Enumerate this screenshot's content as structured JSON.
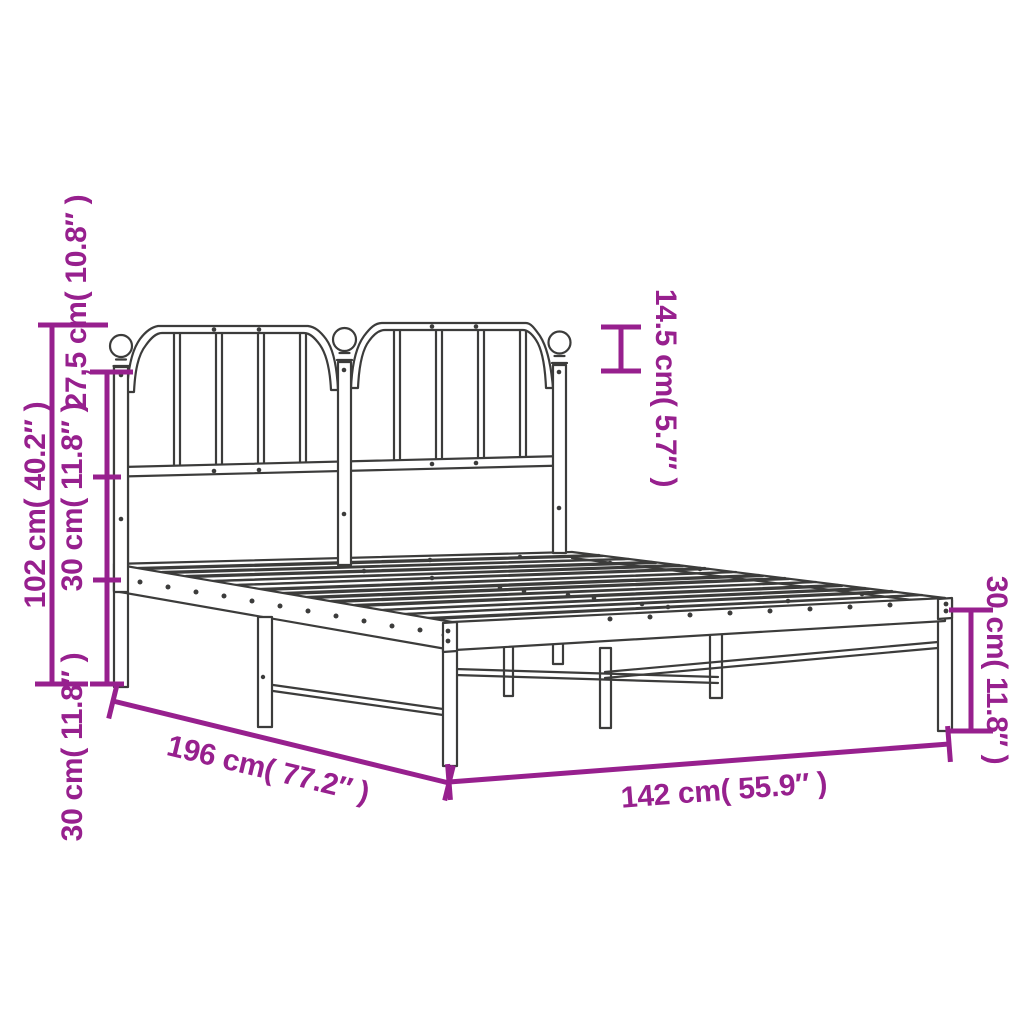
{
  "colors": {
    "dimension": "#97208E",
    "line_art": "#3C3C3B",
    "background": "#FFFFFF"
  },
  "dimensions": {
    "total_height": {
      "cm": "102",
      "inches": "40.2",
      "label": "102 cm( 40.2″ )"
    },
    "headboard_upper_section": {
      "cm": "27,5",
      "inches": "10.8",
      "label": "27,5 cm( 10.8″ )"
    },
    "headboard_middle_section": {
      "cm": "30",
      "inches": "11.8",
      "label": "30 cm( 11.8″ )"
    },
    "headboard_lower_section": {
      "cm": "30",
      "inches": "11.8",
      "label": "30 cm( 11.8″ )"
    },
    "finial_height": {
      "cm": "14.5",
      "inches": "5.7",
      "label": "14.5 cm( 5.7″ )"
    },
    "leg_height": {
      "cm": "30",
      "inches": "11.8",
      "label": "30 cm( 11.8″ )"
    },
    "frame_length": {
      "cm": "196",
      "inches": "77.2",
      "label": "196 cm( 77.2″ )"
    },
    "frame_width": {
      "cm": "142",
      "inches": "55.9",
      "label": "142 cm( 55.9″ )"
    }
  }
}
